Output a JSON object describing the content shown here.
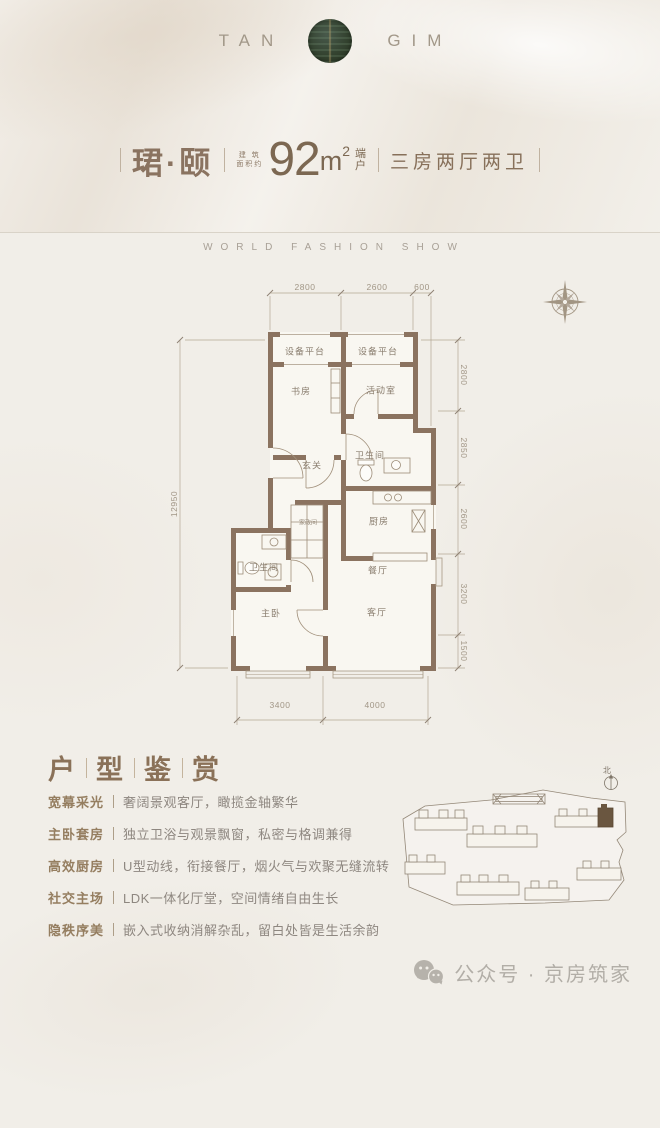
{
  "brand": {
    "word_left": "TAN",
    "word_right": "GIM"
  },
  "title": {
    "name": "珺·颐",
    "area_label_line1": "建 筑",
    "area_label_line2": "面积约",
    "area_number": "92",
    "area_unit": "m",
    "area_superscript": "2",
    "side_label_line1": "端",
    "side_label_line2": "户",
    "spec": "三房两厅两卫"
  },
  "tagline": "WORLD FASHION SHOW",
  "floorplan": {
    "rooms": [
      "设备平台",
      "设备平台",
      "书房",
      "活动室",
      "玄关",
      "卫生间",
      "厨房",
      "家政间",
      "卫生间",
      "主卧",
      "餐厅",
      "客厅"
    ],
    "dims_top": [
      "2800",
      "2600",
      "600"
    ],
    "dims_right": [
      "2800",
      "2850",
      "2600",
      "3200",
      "1500"
    ],
    "dim_left": "12950",
    "dims_bottom": [
      "3400",
      "4000"
    ]
  },
  "appreciation": {
    "title_chars": [
      "户",
      "型",
      "鉴",
      "赏"
    ],
    "items": [
      {
        "lead": "宽幕采光",
        "desc": "奢阔景观客厅，瞰揽金轴繁华"
      },
      {
        "lead": "主卧套房",
        "desc": "独立卫浴与观景飘窗，私密与格调兼得"
      },
      {
        "lead": "高效厨房",
        "desc": "U型动线，衔接餐厅，烟火气与欢聚无缝流转"
      },
      {
        "lead": "社交主场",
        "desc": "LDK一体化厅堂，空间情绪自由生长"
      },
      {
        "lead": "隐秩序美",
        "desc": "嵌入式收纳消解杂乱，留白处皆是生活余韵"
      }
    ]
  },
  "siteplan": {
    "north_label": "北"
  },
  "watermark": {
    "label": "公众号 · 京房筑家"
  },
  "colors": {
    "accent_brown": "#8a7360",
    "wall_brown": "#8b7360",
    "emblem_green": "#2f3e35"
  }
}
